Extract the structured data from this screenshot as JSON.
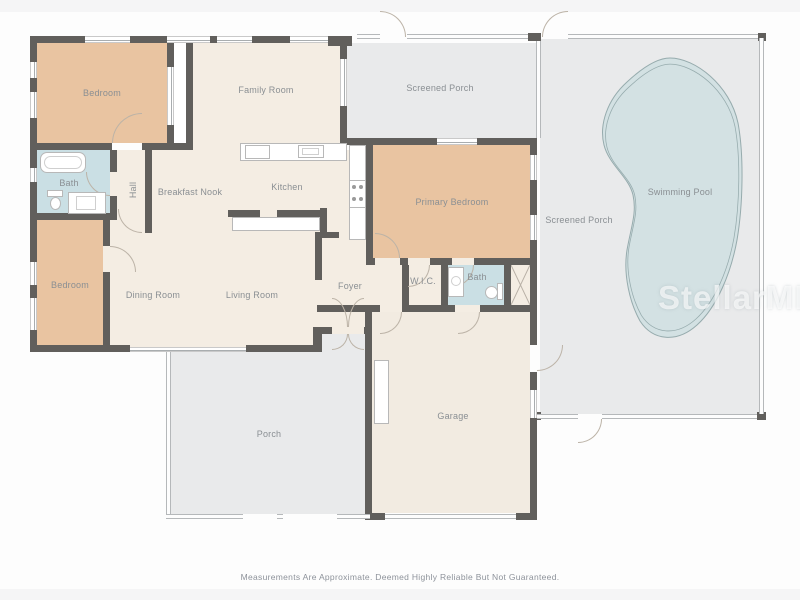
{
  "floorplan": {
    "rooms": {
      "bedroom_top": "Bedroom",
      "family_room": "Family Room",
      "screened_porch_top": "Screened Porch",
      "screened_porch_pool": "Screened Porch",
      "swimming_pool": "Swimming Pool",
      "bath_left": "Bath",
      "hall": "Hall",
      "breakfast_nook": "Breakfast Nook",
      "kitchen": "Kitchen",
      "primary_bedroom": "Primary Bedroom",
      "bedroom_bottom": "Bedroom",
      "dining_room": "Dining Room",
      "living_room": "Living Room",
      "foyer": "Foyer",
      "wic": "W.I.C.",
      "bath_right": "Bath",
      "porch": "Porch",
      "garage": "Garage"
    },
    "footer": {
      "disclaimer": "Measurements Are Approximate. Deemed Highly Reliable But Not Guaranteed."
    },
    "watermark": "StellarMLS",
    "colors": {
      "wall": "#615f5c",
      "bedroom_fill": "#e9c4a1",
      "interior_fill": "#f4ede3",
      "garage_fill": "#f2ebe1",
      "bath_fill": "#cadfe4",
      "porch_fill": "#e9eaeb",
      "pool_fill": "#d3e1e3",
      "pool_outline": "#96abad",
      "label_text": "#8a8f93"
    }
  }
}
